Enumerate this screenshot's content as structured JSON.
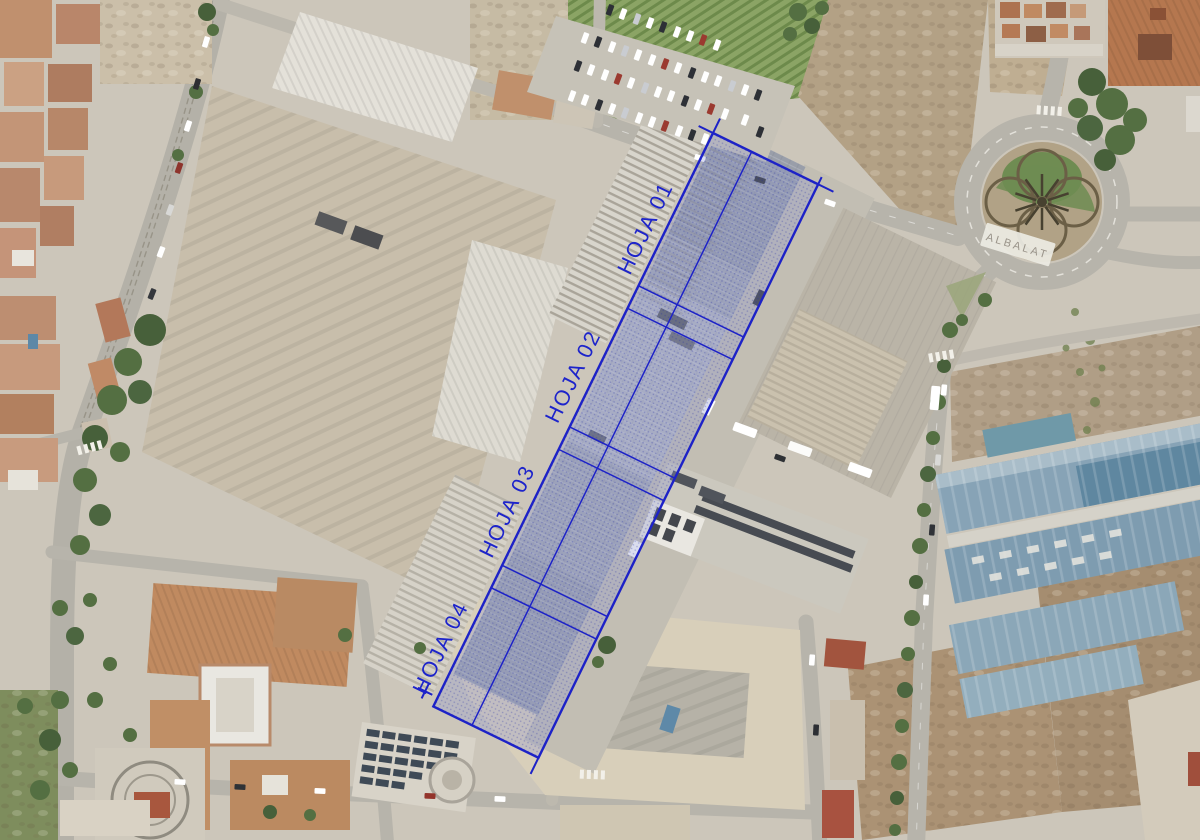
{
  "map": {
    "type": "aerial-orthophoto",
    "overlay": {
      "stroke_color": "#1d22c7",
      "fill_color": "rgba(140,148,210,0.30)",
      "label_color": "#1d24cb",
      "sheet_labels": [
        {
          "label": "HOJA 01"
        },
        {
          "label": "HOJA 02"
        },
        {
          "label": "HOJA 03"
        },
        {
          "label": "HOJA 04"
        }
      ]
    },
    "roundabout": {
      "sign_text": "ALBALAT",
      "sign_text_color": "#9a948a"
    }
  }
}
